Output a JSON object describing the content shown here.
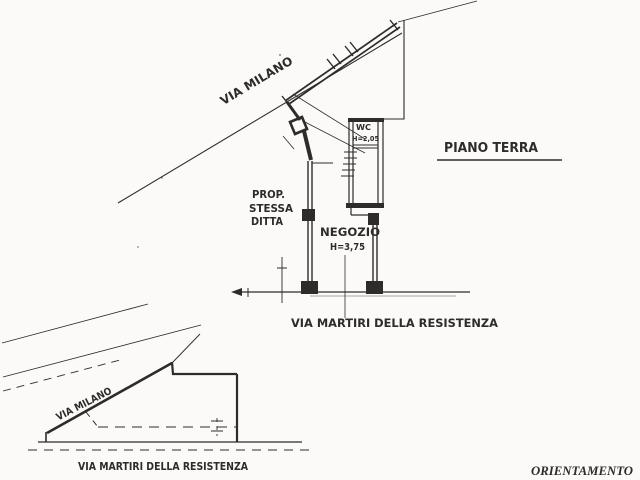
{
  "colors": {
    "ink": "#2e2c2a",
    "paper": "#fbfaf8",
    "light_ink": "#a9a7a2"
  },
  "main_plan": {
    "street_top_label": "VIA MILANO",
    "floor_label": "PIANO TERRA",
    "property": {
      "line1": "PROP.",
      "line2": "STESSA",
      "line3": "DITTA"
    },
    "shop": {
      "name": "NEGOZIO",
      "height": "H=3,75"
    },
    "wc": {
      "name": "WC",
      "height": "H=2,05"
    },
    "street_bottom_label": "VIA MARTIRI DELLA RESISTENZA"
  },
  "site_plan": {
    "street_top_label": "VIA MILANO",
    "street_bottom_label": "VIA MARTIRI DELLA RESISTENZA"
  },
  "footer": {
    "orientation_label": "ORIENTAMENTO"
  }
}
